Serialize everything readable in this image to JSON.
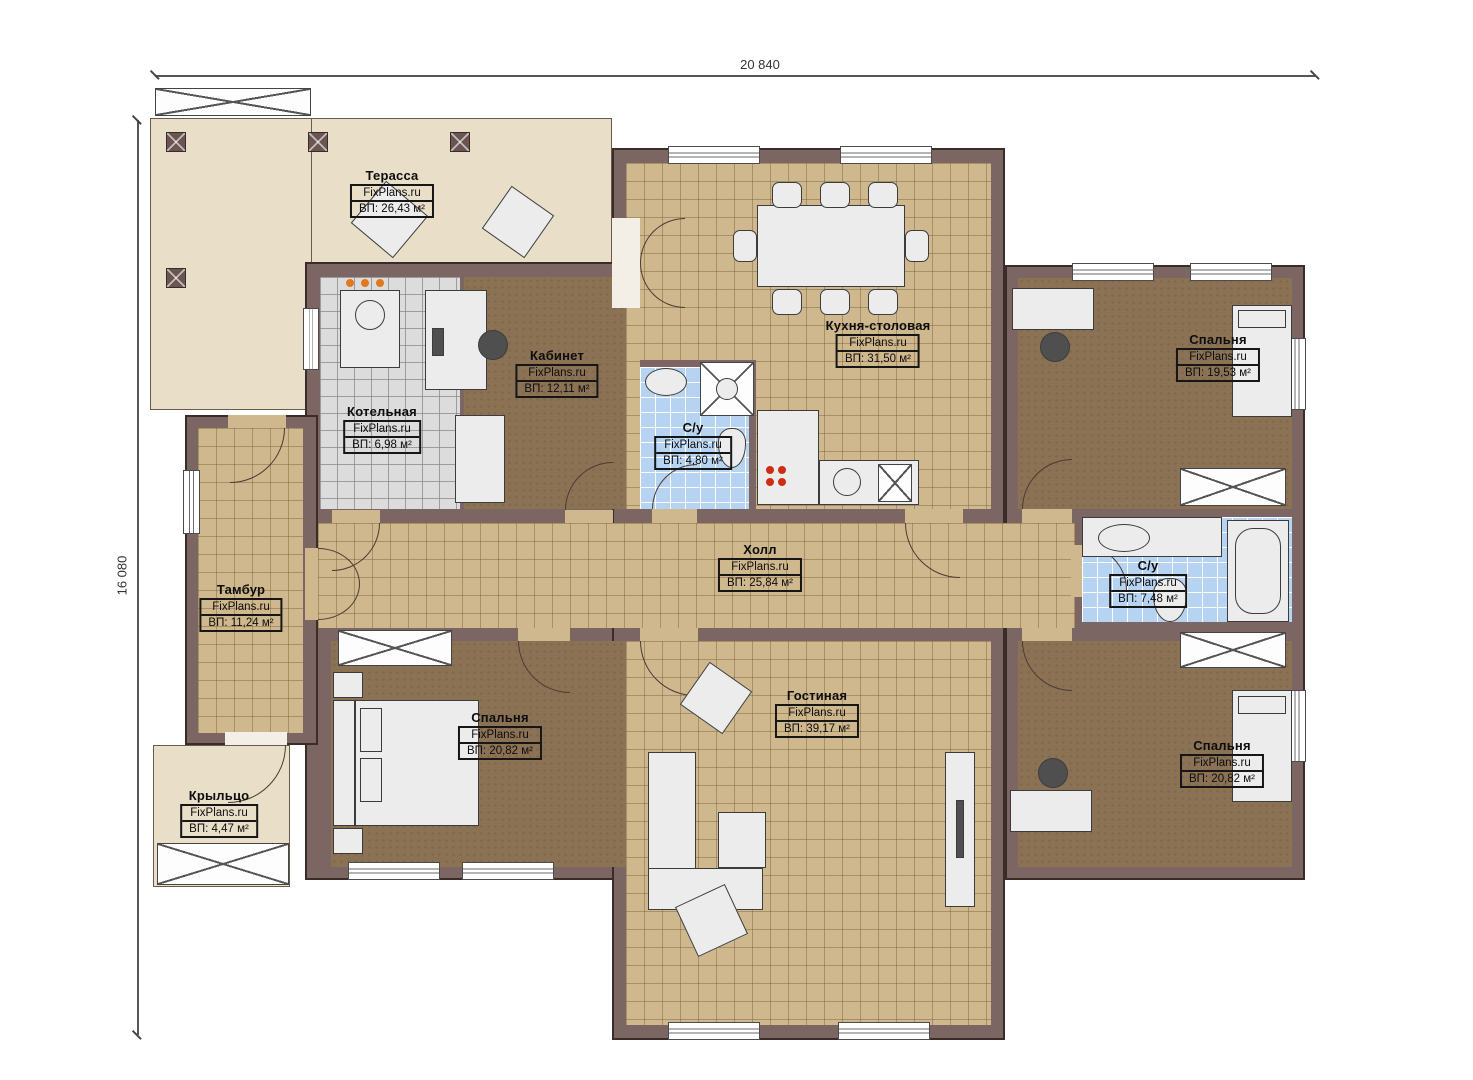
{
  "watermark": "FixPlans.ru",
  "dimensions": {
    "width": "20 840",
    "height": "16 080"
  },
  "rooms": {
    "terrace": {
      "name": "Терасса",
      "area": "ВП: 26,43 м²"
    },
    "boiler": {
      "name": "Котельная",
      "area": "ВП: 6,98 м²"
    },
    "office": {
      "name": "Кабинет",
      "area": "ВП: 12,11 м²"
    },
    "bath1": {
      "name": "С/у",
      "area": "ВП: 4,80 м²"
    },
    "kitchen": {
      "name": "Кухня-столовая",
      "area": "ВП: 31,50 м²"
    },
    "bedroom_tr": {
      "name": "Спальня",
      "area": "ВП: 19,53 м²"
    },
    "tambour": {
      "name": "Тамбур",
      "area": "ВП: 11,24 м²"
    },
    "hall": {
      "name": "Холл",
      "area": "ВП: 25,84 м²"
    },
    "bath2": {
      "name": "С/у",
      "area": "ВП: 7,48 м²"
    },
    "bedroom_bl": {
      "name": "Спальня",
      "area": "ВП: 20,82 м²"
    },
    "living": {
      "name": "Гостиная",
      "area": "ВП: 39,17 м²"
    },
    "bedroom_br": {
      "name": "Спальня",
      "area": "ВП: 20,82 м²"
    },
    "porch": {
      "name": "Крыльцо",
      "area": "ВП: 4,47 м²"
    }
  },
  "colors": {
    "wall": "#7c6663",
    "floor_brown": "#8b7254",
    "tile_tan": "#cfb88d",
    "tile_blue": "#b7d3f2",
    "tile_grey": "#dcdcdc",
    "terrace": "#e9dfc9"
  }
}
